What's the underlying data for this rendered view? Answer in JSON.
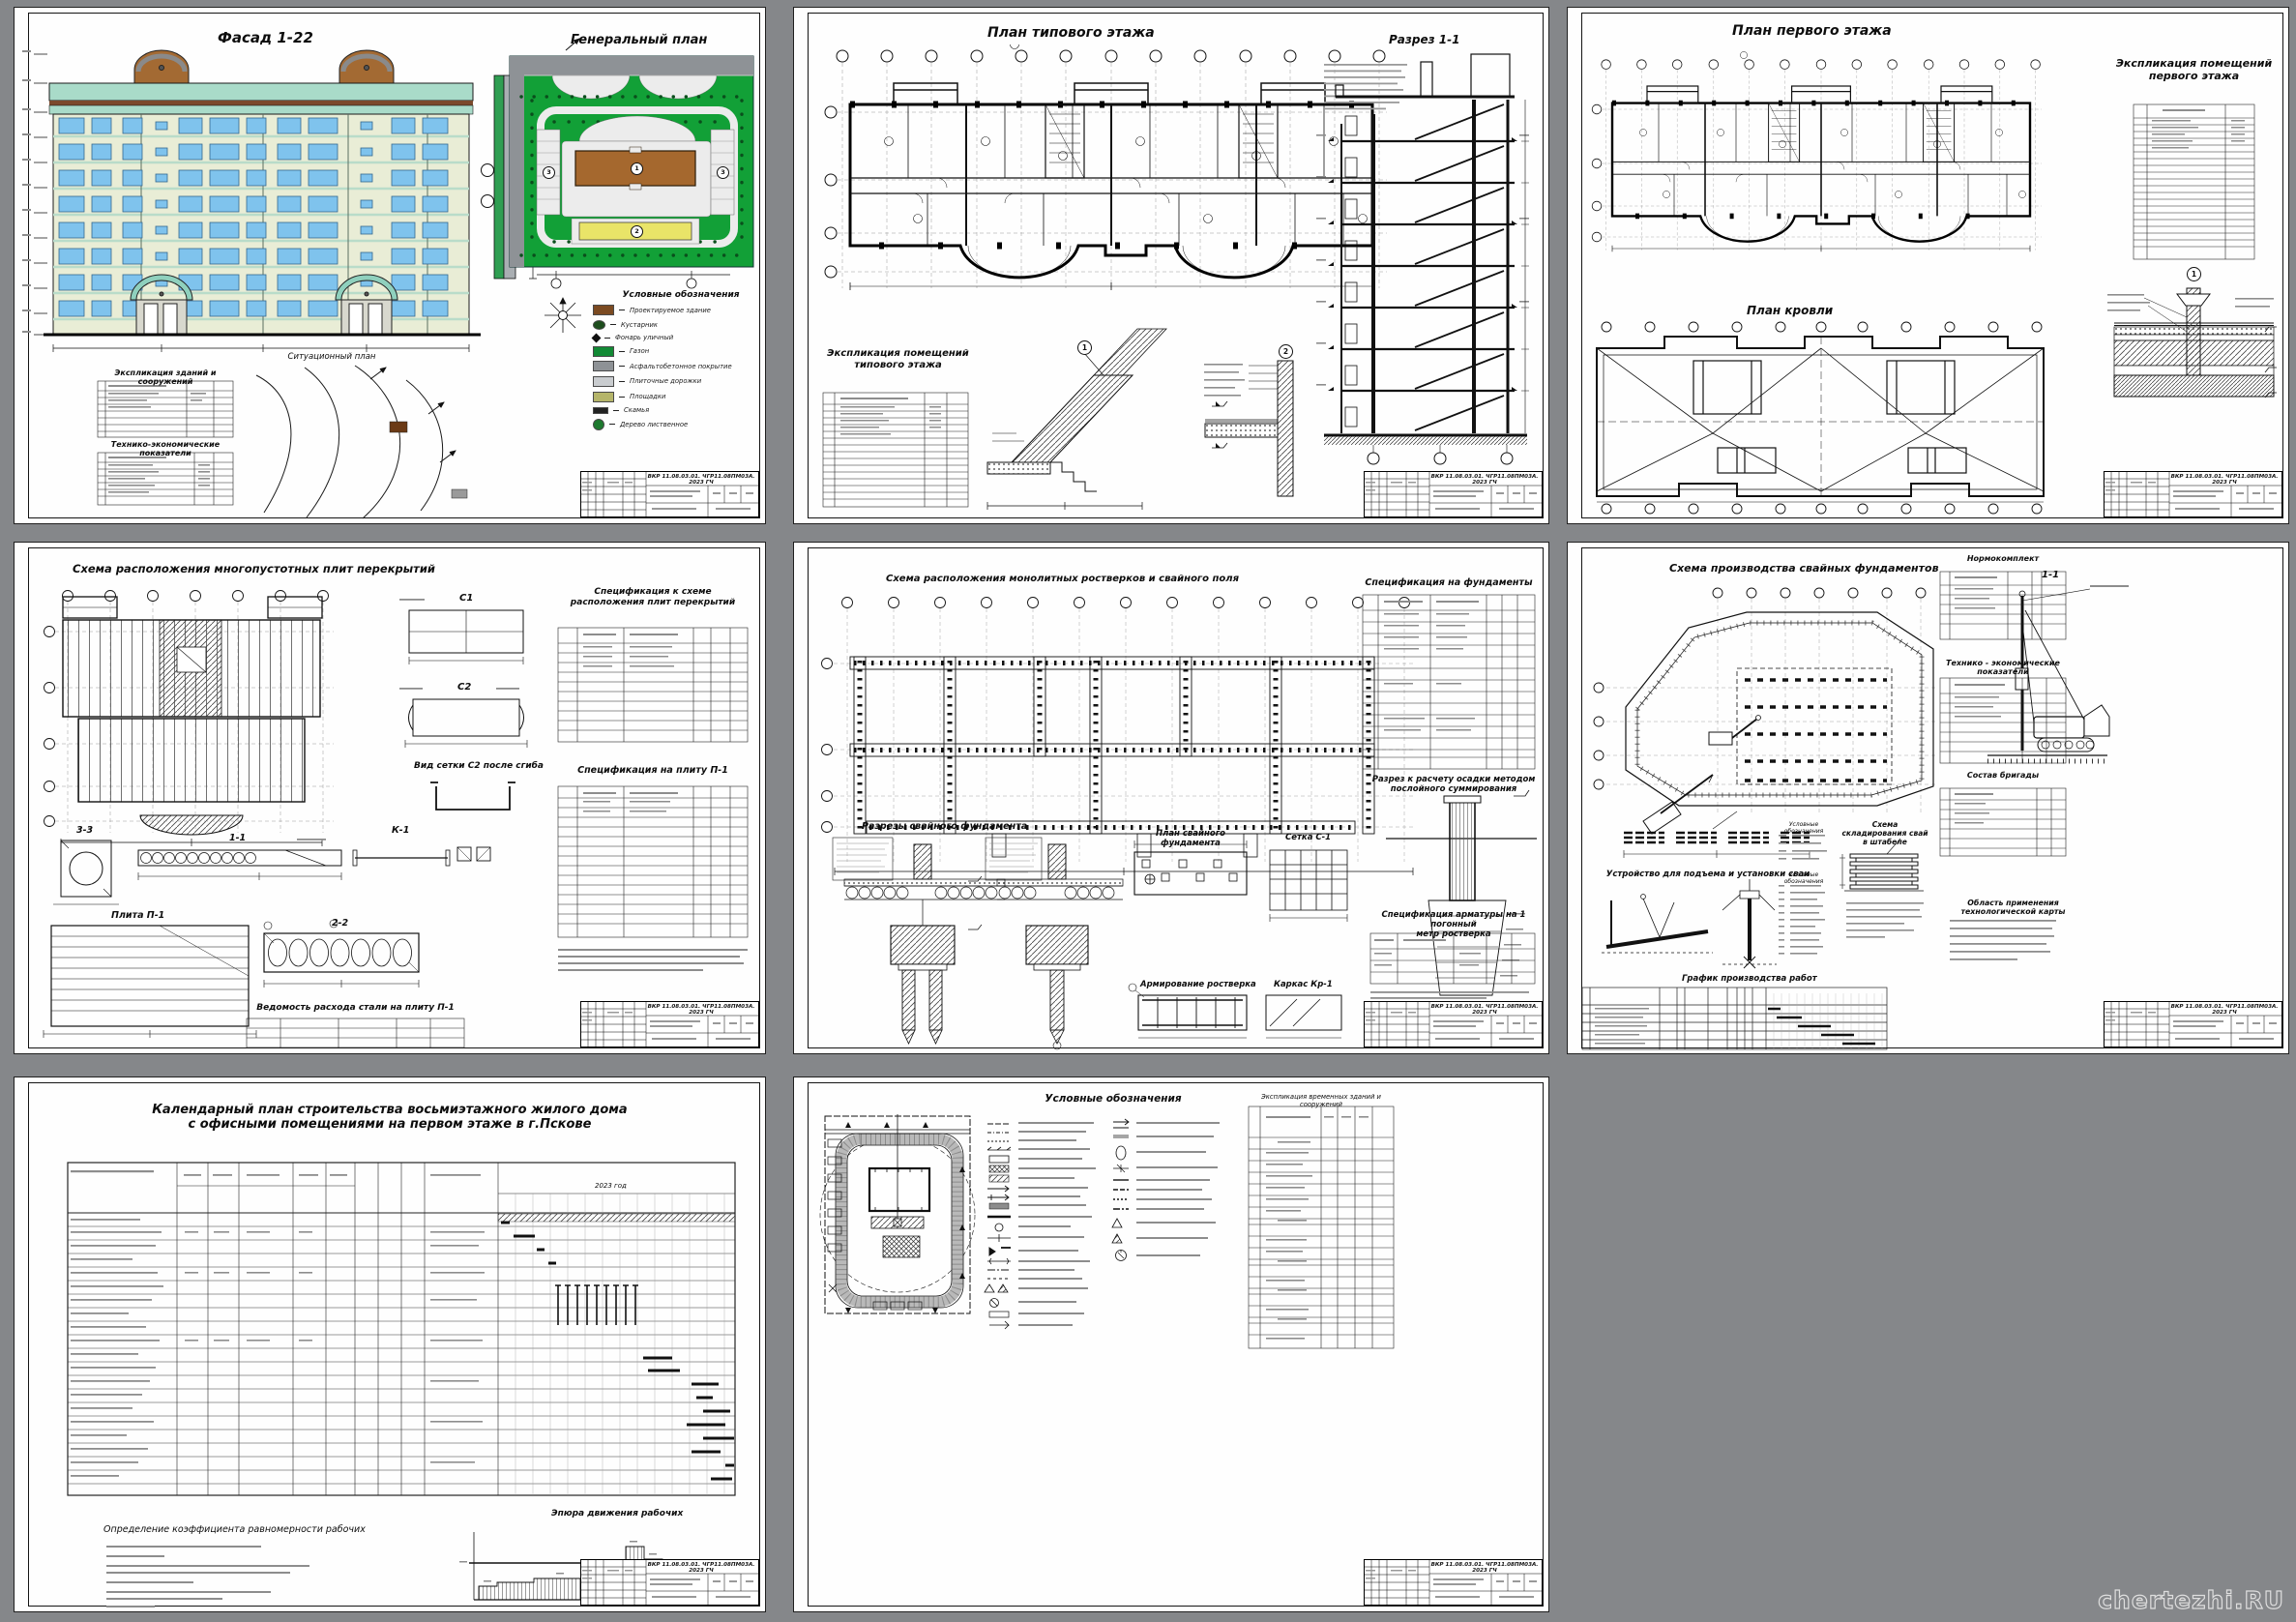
{
  "page": {
    "background": "#85878a",
    "watermark": "chertezhi.RU"
  },
  "stamp_code": "ВКР 11.08.03.01. ЧГР11.08ПМ03А. 2023 ГЧ",
  "colors": {
    "facade_wall": "#e9edd6",
    "facade_band": "#a9dbc9",
    "facade_brown": "#7b4a2d",
    "window_blue": "#7fc3ed",
    "genplan_green": "#12a037",
    "road_gray": "#8e9296",
    "building_brown": "#a5682e",
    "building_yellow": "#e9e468",
    "path_white": "#ececec"
  },
  "s1": {
    "facade_title": "Фасад 1-22",
    "genplan_title": "Генеральный план",
    "situational_plan_title": "Ситуационный план",
    "legend_title": "Условные обозначения",
    "buildings_table_title": "Экспликация зданий и сооружений",
    "tep_table_title": "Технико-экономические показатели",
    "genplan_labels": {
      "main_building": "1",
      "office_building": "2",
      "parking": "3"
    },
    "legend_items": [
      {
        "icon": "building-swatch",
        "color": "#7b4a21",
        "label": "Проектируемое здание"
      },
      {
        "icon": "shrub",
        "color": "#1d4d1d",
        "label": "Кустарник"
      },
      {
        "icon": "lantern",
        "color": "#111111",
        "label": "Фонарь уличный"
      },
      {
        "icon": "lawn-swatch",
        "color": "#128a35",
        "label": "Газон"
      },
      {
        "icon": "asphalt-swatch",
        "color": "#8e9296",
        "label": "Асфальтобетонное покрытие"
      },
      {
        "icon": "tile-swatch",
        "color": "#c9cccf",
        "label": "Плиточные дорожки"
      },
      {
        "icon": "ground-swatch",
        "color": "#b5b56a",
        "label": "Площадки"
      },
      {
        "icon": "bench",
        "color": "#222222",
        "label": "Скамья"
      },
      {
        "icon": "tree",
        "color": "#1d7a2e",
        "label": "Дерево лиственное"
      }
    ]
  },
  "s2": {
    "plan_title": "План типового этажа",
    "section_title": "Разрез 1-1",
    "explication_title": "Экспликация помещений типового этажа",
    "node1": "1",
    "node2": "2"
  },
  "s3": {
    "plan_title": "План первого этажа",
    "explication_title": "Экспликация помещений первого этажа",
    "roof_plan_title": "План кровли",
    "node1": "1"
  },
  "s4": {
    "scheme_title": "Схема расположения многопустотных плит перекрытий",
    "spec_scheme_title": "Спецификация к схеме расположения плит перекрытий",
    "spec_plate_title": "Спецификация на плиту П-1",
    "mesh_c1": "С1",
    "mesh_c2": "С2",
    "mesh_bent_title": "Вид сетки С2 после сгиба",
    "frame_k1": "К-1",
    "section_33": "3-3",
    "section_11": "1-1",
    "section_22": "2-2",
    "plate_title": "Плита П-1",
    "steel_table_title": "Ведомость расхода стали на плиту П-1"
  },
  "s5": {
    "scheme_title": "Схема расположения монолитных ростверков и свайного поля",
    "spec_title": "Спецификация на фундаменты",
    "settlement_title_1": "Разрез к расчету осадки методом",
    "settlement_title_2": "послойного суммирования",
    "sections_title": "Разрезы свайного фундамента",
    "pile_plan_title": "План свайного фундамента",
    "mesh_title": "Сетка С-1",
    "reinforcement_title": "Армирование  ростверка",
    "frame_title": "Каркас Кр-1",
    "rebar_spec_title_1": "Спецификация арматуры на 1 погонный",
    "rebar_spec_title_2": "метр ростверка"
  },
  "s6": {
    "scheme_title": "Схема производства свайных фундаментов",
    "section_label": "1-1",
    "normokomplekt_title": "Нормокомплект",
    "tep_title": "Технико - экономические показатели",
    "brigade_title": "Состав бригады",
    "stacking_title_1": "Схема складирования свай",
    "stacking_title_2": "в штабеле",
    "lifting_title": "Устройство для подъема и установки сваи",
    "legend_title_1": "Условные обозначения",
    "legend_title_2": "Условные обозначения",
    "application_title": "Область применения технологической карты",
    "schedule_title": "График производства работ"
  },
  "s7": {
    "title_1": "Календарный план строительства восьмиэтажного жилого дома",
    "title_2": "с офисными помещениями на первом этаже в г.Пскове",
    "coefficient_title": "Определение коэффициента равномерности рабочих",
    "epure_title": "Эпюра движения рабочих",
    "year_label": "2023 год"
  },
  "s8": {
    "legend_title": "Условные обозначения",
    "explication_title": "Экспликация временных зданий и сооружений"
  }
}
